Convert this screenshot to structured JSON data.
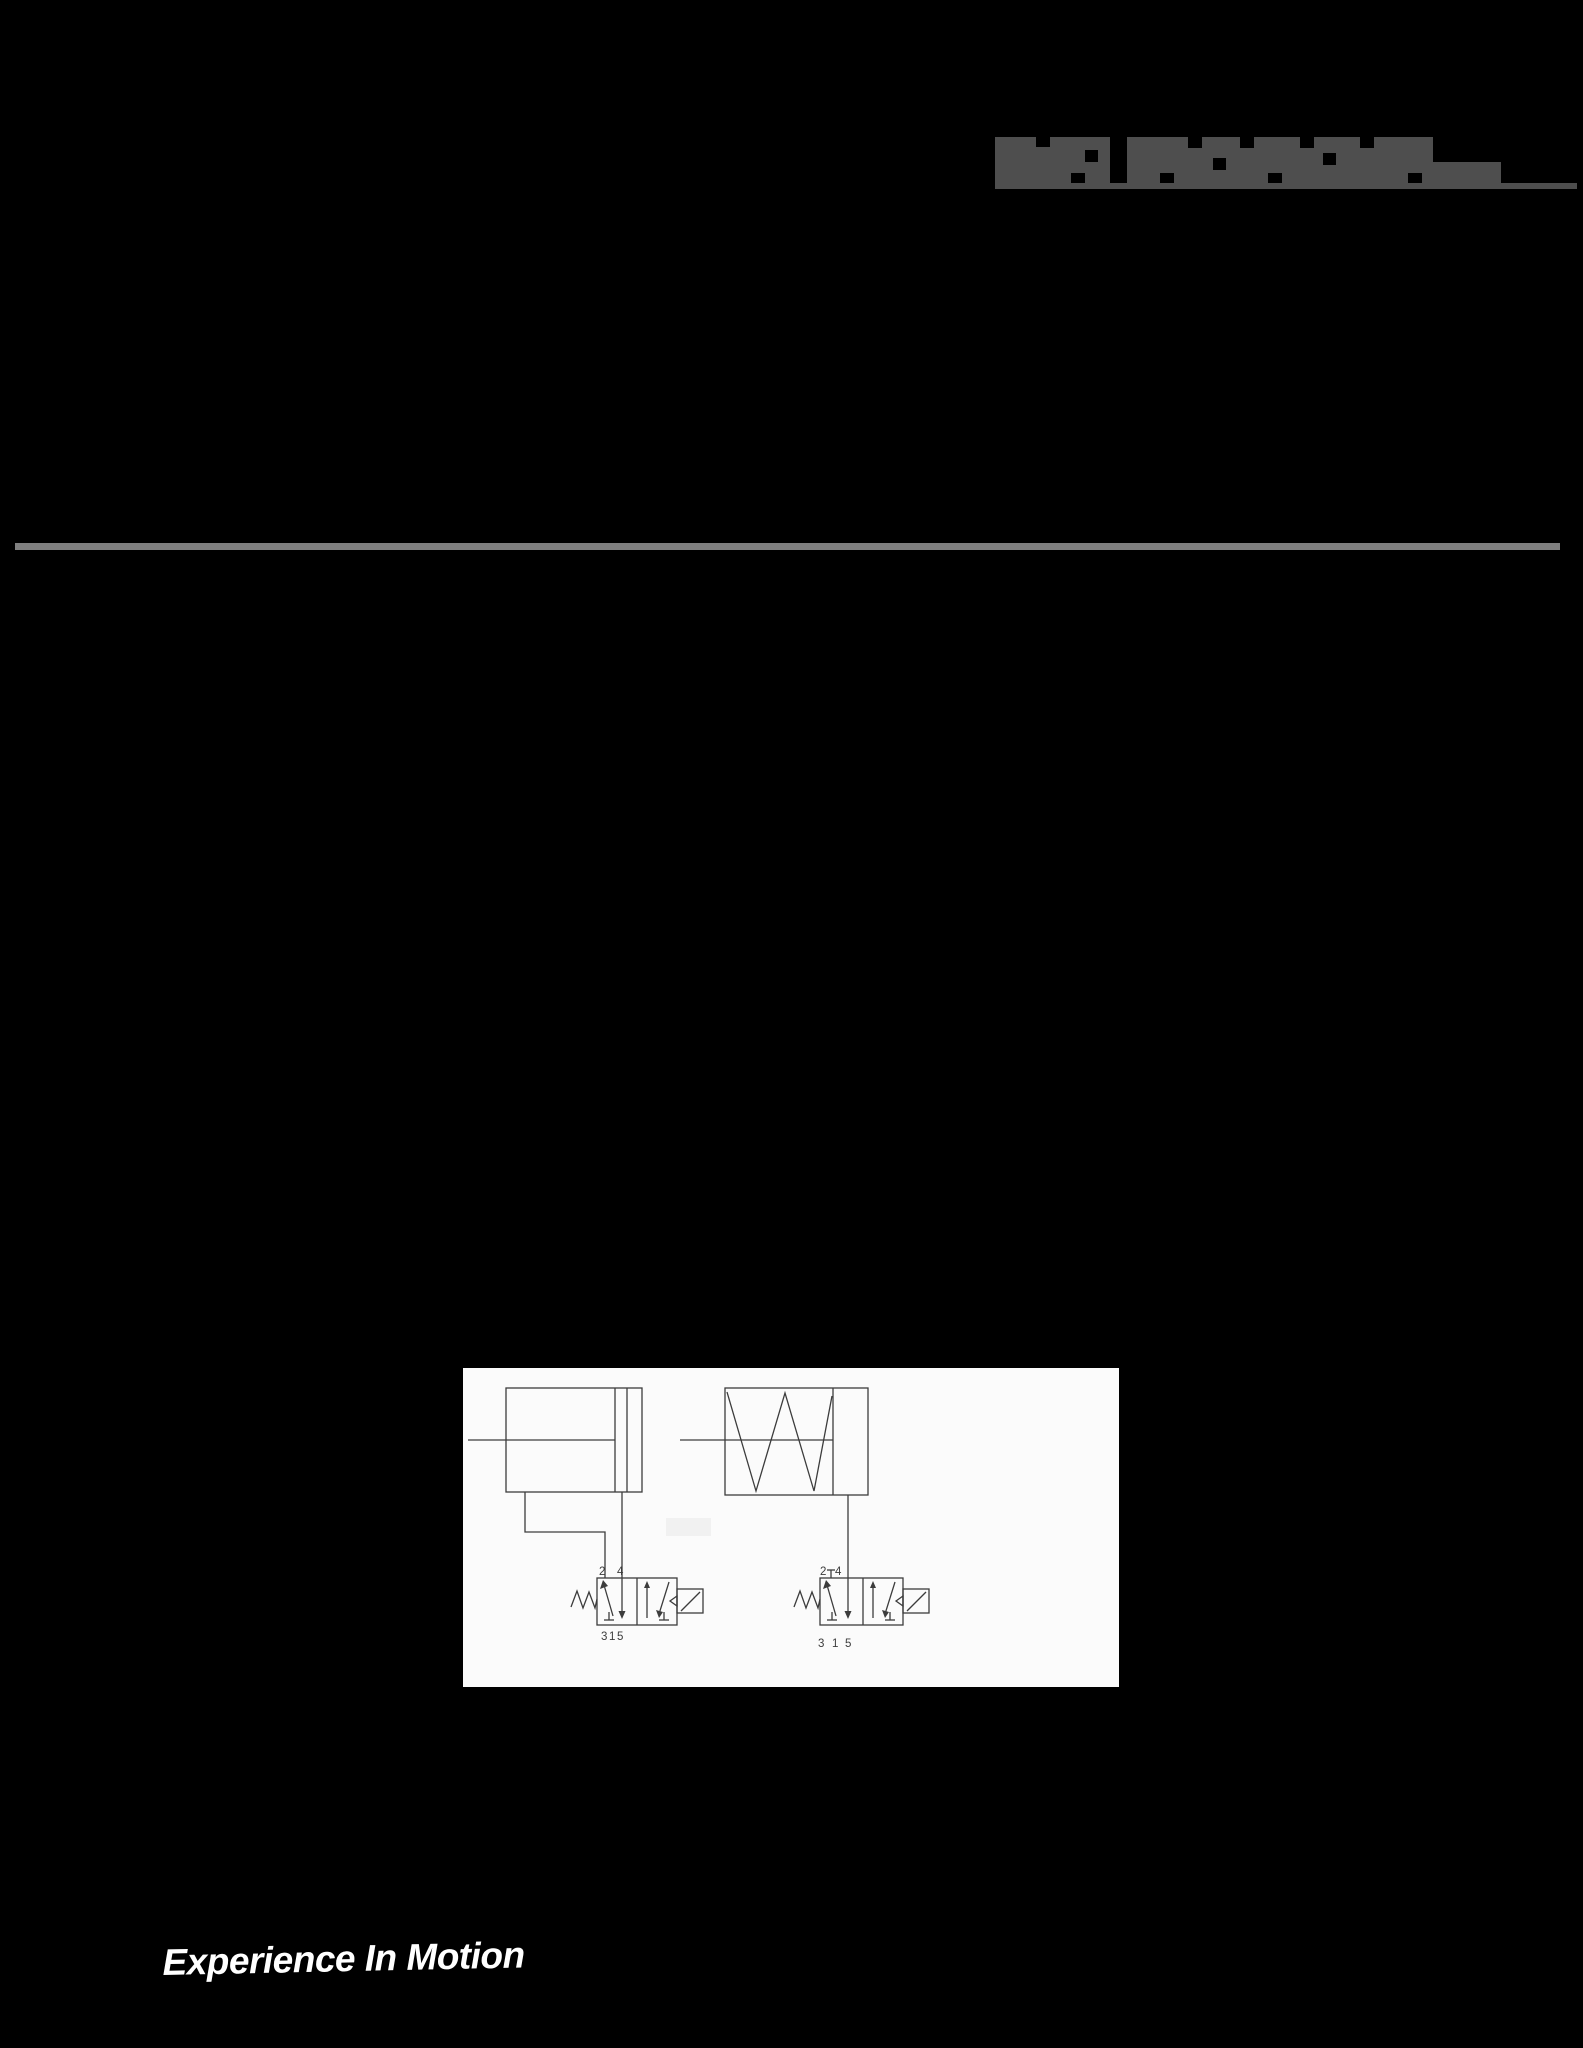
{
  "colors": {
    "background": "#000000",
    "logo_gray": "#4e4e4e",
    "divider_gray": "#7f7f7f",
    "panel_background": "#fbfbfb",
    "diagram_line": "#3c3c3c",
    "tagline_white": "#ffffff"
  },
  "header": {
    "logo_icon": "flowserve-logo-pixelated"
  },
  "diagram": {
    "valves": {
      "left": {
        "top_ports": [
          "2",
          "4"
        ],
        "bottom_ports": [
          "3",
          "1",
          "5"
        ]
      },
      "right": {
        "top_ports": [
          "2",
          "4"
        ],
        "bottom_ports": [
          "3",
          "1",
          "5"
        ]
      }
    }
  },
  "footer": {
    "tagline": "Experience In Motion"
  }
}
